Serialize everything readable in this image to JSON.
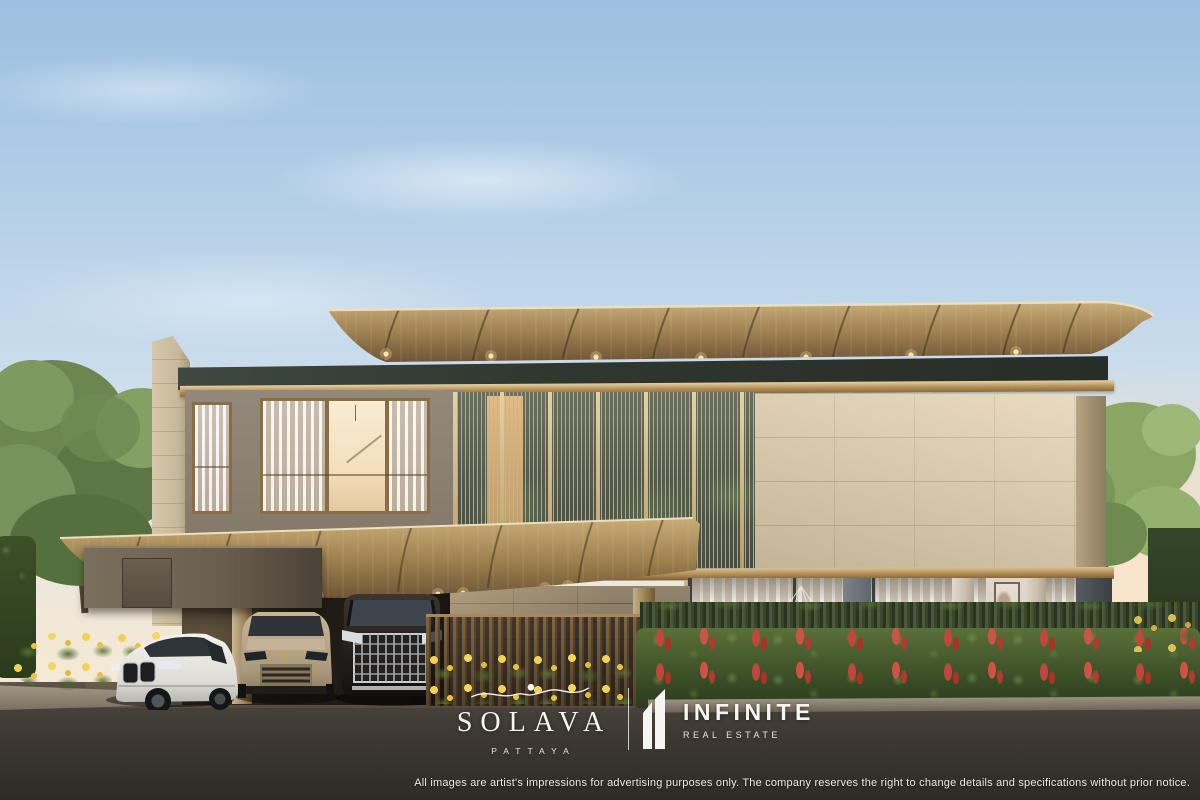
{
  "branding": {
    "solava": {
      "name": "SOLAVA",
      "location": "PATTAYA",
      "emblem": "sun-wave-emblem"
    },
    "infinite": {
      "name": "INFINITE",
      "subtitle": "REAL ESTATE",
      "emblem": "one-building-emblem"
    }
  },
  "disclaimer": "All images are artist's impressions for advertising purposes only. The company reserves the right to change details and specifications without prior notice.",
  "scene": {
    "type": "architectural-exterior-render",
    "subject": "two-storey modern luxury villa with curved timber roofs, louvred glass facade, stone walls, carport with three cars, flowering hedge and street foreground"
  },
  "colors": {
    "sky_top": "#9cc0e0",
    "sky_horizon": "#f7ead6",
    "roof_wood": "#a9895c",
    "fascia_dark": "#39403b",
    "bronze_trim": "#b28f58",
    "stone_wall": "#d8cab0",
    "taupe_wall": "#877b6c",
    "hedge_green": "#44552f",
    "flower_red": "#c6453a",
    "flower_yellow": "#e8c84a",
    "road": "#3c3833",
    "logo_text": "#f7f5f1"
  }
}
